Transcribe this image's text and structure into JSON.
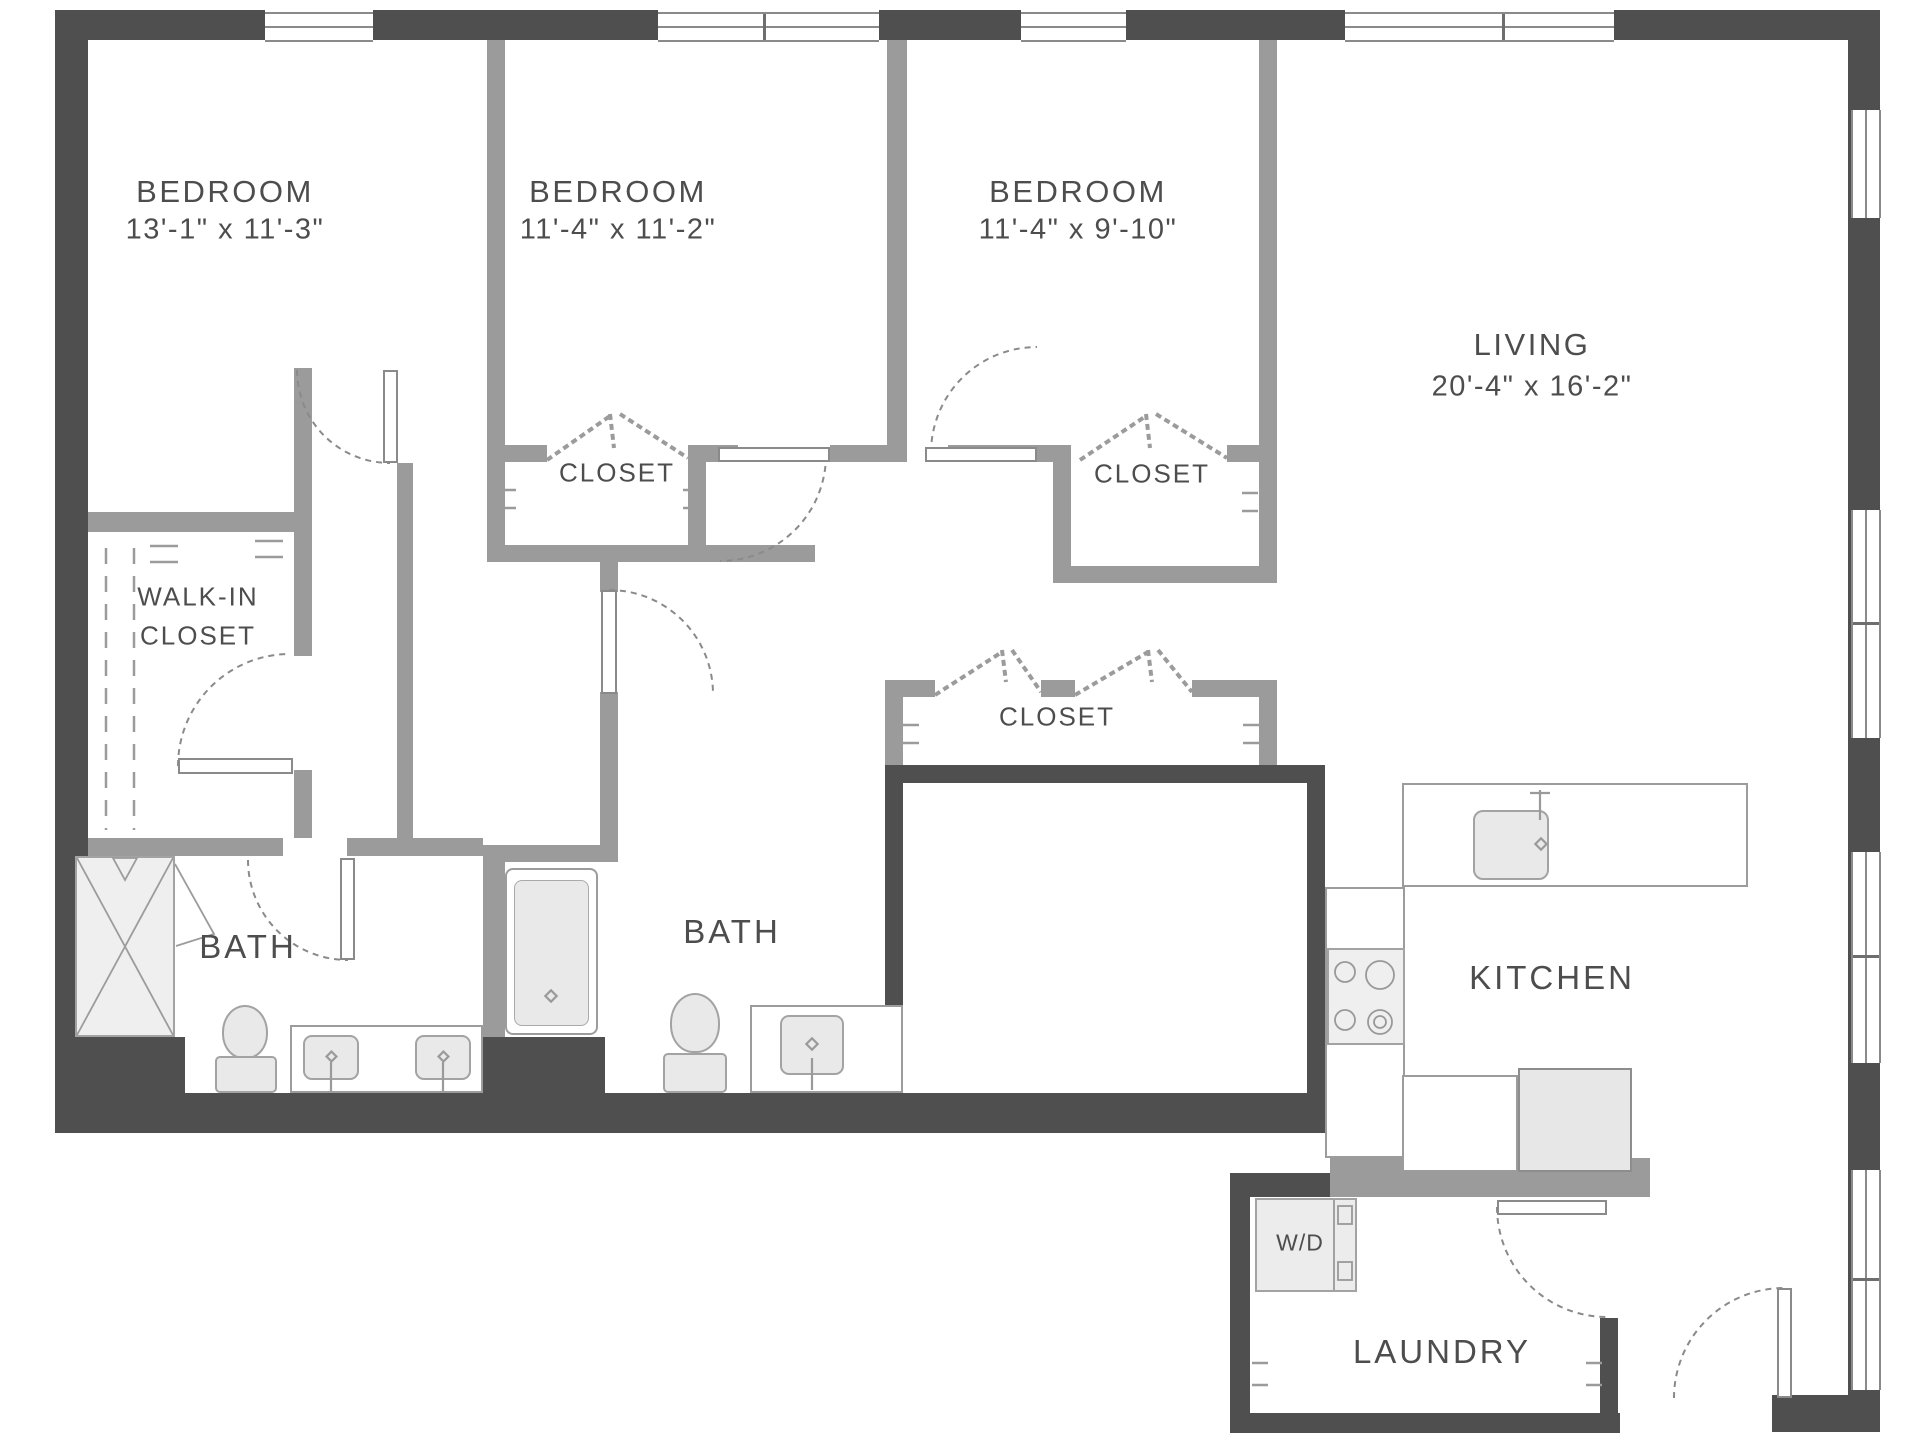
{
  "plan": {
    "rooms": {
      "bedroom1": {
        "name": "BEDROOM",
        "dims": "13'-1\" x 11'-3\""
      },
      "bedroom2": {
        "name": "BEDROOM",
        "dims": "11'-4\" x 11'-2\""
      },
      "bedroom3": {
        "name": "BEDROOM",
        "dims": "11'-4\" x 9'-10\""
      },
      "living": {
        "name": "LIVING",
        "dims": "20'-4\" x 16'-2\""
      },
      "walk_in_closet": {
        "line1": "WALK-IN",
        "line2": "CLOSET"
      },
      "bath1": {
        "name": "BATH"
      },
      "bath2": {
        "name": "BATH"
      },
      "closet_bedroom2": {
        "name": "CLOSET"
      },
      "closet_bedroom3": {
        "name": "CLOSET"
      },
      "closet_hall": {
        "name": "CLOSET"
      },
      "kitchen": {
        "name": "KITCHEN"
      },
      "laundry": {
        "name": "LAUNDRY"
      },
      "washer_dryer": {
        "name": "W/D"
      }
    },
    "colors": {
      "exterior_wall": "#4f4f4f",
      "interior_wall": "#9b9b9b",
      "fixture_fill": "#e9e9e9",
      "line": "#999999",
      "text": "#4d4d4d",
      "background": "#ffffff"
    }
  }
}
